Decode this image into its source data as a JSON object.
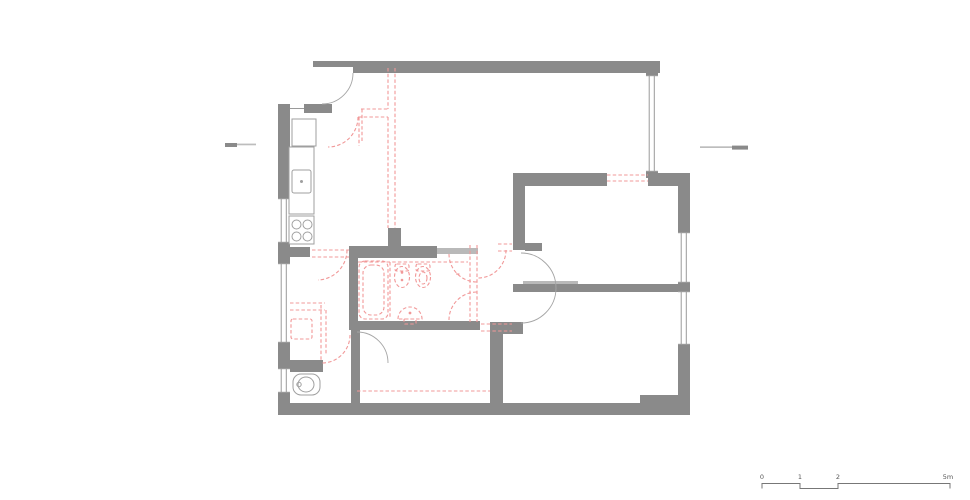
{
  "title": "apartment-floor-plan-demolition",
  "colors": {
    "wall": "#8a8a8a",
    "wall_light": "#b9b9b9",
    "line": "#9a9a9a",
    "door": "#a5a5a5",
    "fixture": "#9f9f9f",
    "demolition": "#f19898",
    "mark_dark": "#8a8a8a",
    "mark_light": "#bdbdbd",
    "scale_line": "#777777",
    "text": "#555555",
    "bg": "#ffffff"
  },
  "plan": {
    "walls": [
      {
        "x": 313,
        "y": 61,
        "w": 347,
        "h": 12
      },
      {
        "x": 646,
        "y": 61,
        "w": 12,
        "h": 117
      },
      {
        "x": 278,
        "y": 104,
        "w": 12,
        "h": 311
      },
      {
        "x": 304,
        "y": 104,
        "w": 28,
        "h": 9
      },
      {
        "x": 515,
        "y": 173,
        "w": 92,
        "h": 13
      },
      {
        "x": 648,
        "y": 173,
        "w": 40,
        "h": 13
      },
      {
        "x": 678,
        "y": 173,
        "w": 12,
        "h": 242
      },
      {
        "x": 278,
        "y": 403,
        "w": 412,
        "h": 12
      },
      {
        "x": 640,
        "y": 395,
        "w": 50,
        "h": 8
      },
      {
        "x": 513,
        "y": 173,
        "w": 12,
        "h": 77
      },
      {
        "x": 525,
        "y": 243,
        "w": 17,
        "h": 8
      },
      {
        "x": 288,
        "y": 247,
        "w": 22,
        "h": 10
      },
      {
        "x": 349,
        "y": 246,
        "w": 88,
        "h": 12
      },
      {
        "x": 437,
        "y": 248,
        "w": 41,
        "h": 6,
        "shade": "light"
      },
      {
        "x": 349,
        "y": 246,
        "w": 9,
        "h": 84
      },
      {
        "x": 349,
        "y": 321,
        "w": 131,
        "h": 9
      },
      {
        "x": 388,
        "y": 228,
        "w": 13,
        "h": 22
      },
      {
        "x": 523,
        "y": 281,
        "w": 55,
        "h": 6,
        "shade": "light"
      },
      {
        "x": 513,
        "y": 284,
        "w": 175,
        "h": 8
      },
      {
        "x": 490,
        "y": 322,
        "w": 33,
        "h": 12
      },
      {
        "x": 490,
        "y": 322,
        "w": 13,
        "h": 81
      },
      {
        "x": 290,
        "y": 360,
        "w": 33,
        "h": 12
      },
      {
        "x": 351,
        "y": 330,
        "w": 9,
        "h": 73
      }
    ],
    "white_notches": [
      {
        "x": 313,
        "y": 67,
        "w": 40,
        "h": 6
      }
    ],
    "windows": [
      {
        "x": 278,
        "y": 198,
        "w": 12,
        "h": 45
      },
      {
        "x": 278,
        "y": 263,
        "w": 12,
        "h": 80
      },
      {
        "x": 278,
        "y": 368,
        "w": 12,
        "h": 25
      },
      {
        "x": 646,
        "y": 75,
        "w": 12,
        "h": 97
      },
      {
        "x": 678,
        "y": 232,
        "w": 12,
        "h": 51
      },
      {
        "x": 678,
        "y": 291,
        "w": 12,
        "h": 54
      }
    ],
    "door_arcs": [
      "M 353,73 A 31,31 0 0 1 322,104",
      "M 521,253 A 35,35 0 0 1 556,288",
      "M 556,288 A 35,35 0 0 1 521,323",
      "M 357,332 A 31,31 0 0 1 388,363"
    ],
    "thin_lines": [
      [
        290,
        108.5,
        304,
        108.5
      ]
    ],
    "demolition": {
      "lines": [
        [
          388,
          68,
          388,
          109
        ],
        [
          388,
          117,
          388,
          228
        ],
        [
          395,
          68,
          395,
          228
        ],
        [
          361,
          109,
          388,
          109
        ],
        [
          358,
          117,
          388,
          117
        ],
        [
          362,
          109,
          362,
          142
        ],
        [
          359,
          117,
          359,
          146
        ],
        [
          470,
          245,
          470,
          322
        ],
        [
          477,
          245,
          477,
          322
        ],
        [
          358,
          262,
          468,
          262
        ],
        [
          390,
          262,
          390,
          318
        ],
        [
          607,
          175,
          648,
          175
        ],
        [
          607,
          181,
          648,
          181
        ],
        [
          312,
          250,
          349,
          250
        ],
        [
          312,
          257,
          349,
          257
        ],
        [
          290,
          303,
          325,
          303
        ],
        [
          290,
          310,
          325,
          310
        ],
        [
          321,
          305,
          321,
          360
        ],
        [
          326,
          310,
          326,
          355
        ],
        [
          481,
          324,
          512,
          324
        ],
        [
          481,
          331,
          512,
          331
        ],
        [
          357,
          391,
          490,
          391
        ],
        [
          498,
          244,
          512,
          244
        ],
        [
          498,
          251,
          512,
          251
        ],
        [
          456,
          274,
          461,
          274
        ]
      ],
      "arcs": [
        "M 358,117 A 30,30 0 0 1 328,147",
        "M 347,250 A 30,30 0 0 1 318,280",
        "M 449,254 A 28,28 0 0 0 477,282",
        "M 449,320 A 28,28 0 0 1 477,292",
        "M 506,250 A 28,28 0 0 1 478,278",
        "M 350,335 A 28,28 0 0 1 322,363"
      ],
      "rects": [
        {
          "x": 359,
          "y": 261,
          "w": 29,
          "h": 58,
          "r": 6
        },
        {
          "x": 363,
          "y": 265,
          "w": 21,
          "h": 50,
          "r": 8
        },
        {
          "x": 291,
          "y": 319,
          "w": 21,
          "h": 20,
          "r": 2
        },
        {
          "x": 395,
          "y": 264,
          "w": 14,
          "h": 7,
          "r": 2
        },
        {
          "x": 416,
          "y": 264,
          "w": 14,
          "h": 7,
          "r": 2
        },
        {
          "x": 404,
          "y": 319,
          "w": 12,
          "h": 5,
          "r": 1
        }
      ],
      "ellipses": [
        {
          "cx": 402,
          "cy": 277,
          "rx": 7.5,
          "ry": 10.5
        },
        {
          "cx": 423,
          "cy": 277,
          "rx": 7.5,
          "ry": 10.5
        },
        {
          "cx": 423,
          "cy": 278,
          "rx": 4,
          "ry": 6
        }
      ],
      "paths": [
        "M 398,319 A 12,12 0 0 1 422,319 Z"
      ],
      "dots": [
        {
          "cx": 402,
          "cy": 272.5,
          "r": 1.3
        },
        {
          "cx": 402,
          "cy": 280,
          "r": 1.3
        },
        {
          "cx": 410,
          "cy": 313,
          "r": 1.4
        }
      ]
    },
    "fixtures": {
      "rects": [
        {
          "x": 292,
          "y": 119,
          "w": 24,
          "h": 27
        },
        {
          "x": 289,
          "y": 147,
          "w": 25,
          "h": 67
        },
        {
          "x": 292,
          "y": 170,
          "w": 19,
          "h": 23,
          "r": 2
        },
        {
          "x": 289,
          "y": 216,
          "w": 25,
          "h": 28
        },
        {
          "x": 293,
          "y": 374,
          "w": 27,
          "h": 21,
          "r": 8
        }
      ],
      "circles": [
        {
          "cx": 296.5,
          "cy": 224.5,
          "r": 4.5
        },
        {
          "cx": 307.5,
          "cy": 224.5,
          "r": 4.5
        },
        {
          "cx": 296.5,
          "cy": 236.5,
          "r": 4.5
        },
        {
          "cx": 307.5,
          "cy": 236.5,
          "r": 4.5
        },
        {
          "cx": 299,
          "cy": 384.5,
          "r": 2.2
        }
      ],
      "ellipses": [
        {
          "cx": 306,
          "cy": 384.5,
          "rx": 8,
          "ry": 7.5
        }
      ],
      "dots": [
        {
          "cx": 301.5,
          "cy": 181.5,
          "r": 1.5
        }
      ]
    },
    "section_marks": [
      {
        "x": 225,
        "y": 143,
        "w": 12,
        "h": 4,
        "shade": "dark"
      },
      {
        "x": 237,
        "y": 143.6,
        "w": 19,
        "h": 1.7,
        "shade": "light"
      },
      {
        "x": 700,
        "y": 146.3,
        "w": 32,
        "h": 1.7,
        "shade": "light"
      },
      {
        "x": 732,
        "y": 145.6,
        "w": 16,
        "h": 4,
        "shade": "dark"
      }
    ]
  },
  "scale_bar": {
    "path": "M 762,488.5 L 762,483.5 L 800,483.5 L 800,488.5 L 838,488.5 L 838,483.5 L 950,483.5 L 950,488.5",
    "labels": [
      {
        "text": "0",
        "x": 762
      },
      {
        "text": "1",
        "x": 800
      },
      {
        "text": "2",
        "x": 838
      },
      {
        "text": "5m",
        "x": 948
      }
    ],
    "label_y": 479
  }
}
